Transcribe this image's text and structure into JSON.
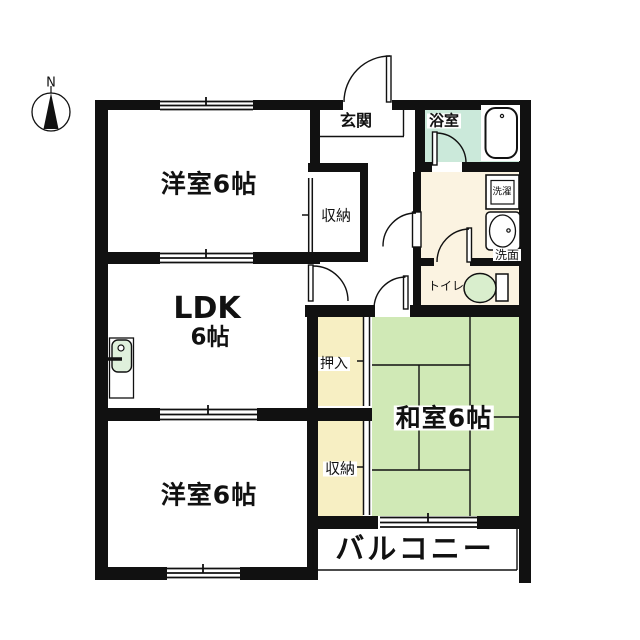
{
  "title": "apartment-floor-plan",
  "compass": {
    "north_label": "N"
  },
  "rooms": {
    "western_room_top": "洋室6帖",
    "western_room_bottom": "洋室6帖",
    "ldk_line1": "LDK",
    "ldk_line2": "6帖",
    "japanese_room": "和室6帖",
    "entrance": "玄関",
    "bathroom": "浴室",
    "laundry": "洗濯",
    "washroom": "洗面",
    "toilet": "トイレ",
    "closet_top": "収納",
    "closet_bottom": "収納",
    "oshiire": "押入",
    "balcony": "バルコニー"
  },
  "colors": {
    "wall": "#111111",
    "bathroom_floor": "#cbe9da",
    "sanitary_floor": "#fbf3e1",
    "closet_floor": "#f7efc3",
    "tatami_floor": "#d0e9b6",
    "fixture_green": "#d9eecd",
    "sink_green": "#dff0dc"
  }
}
